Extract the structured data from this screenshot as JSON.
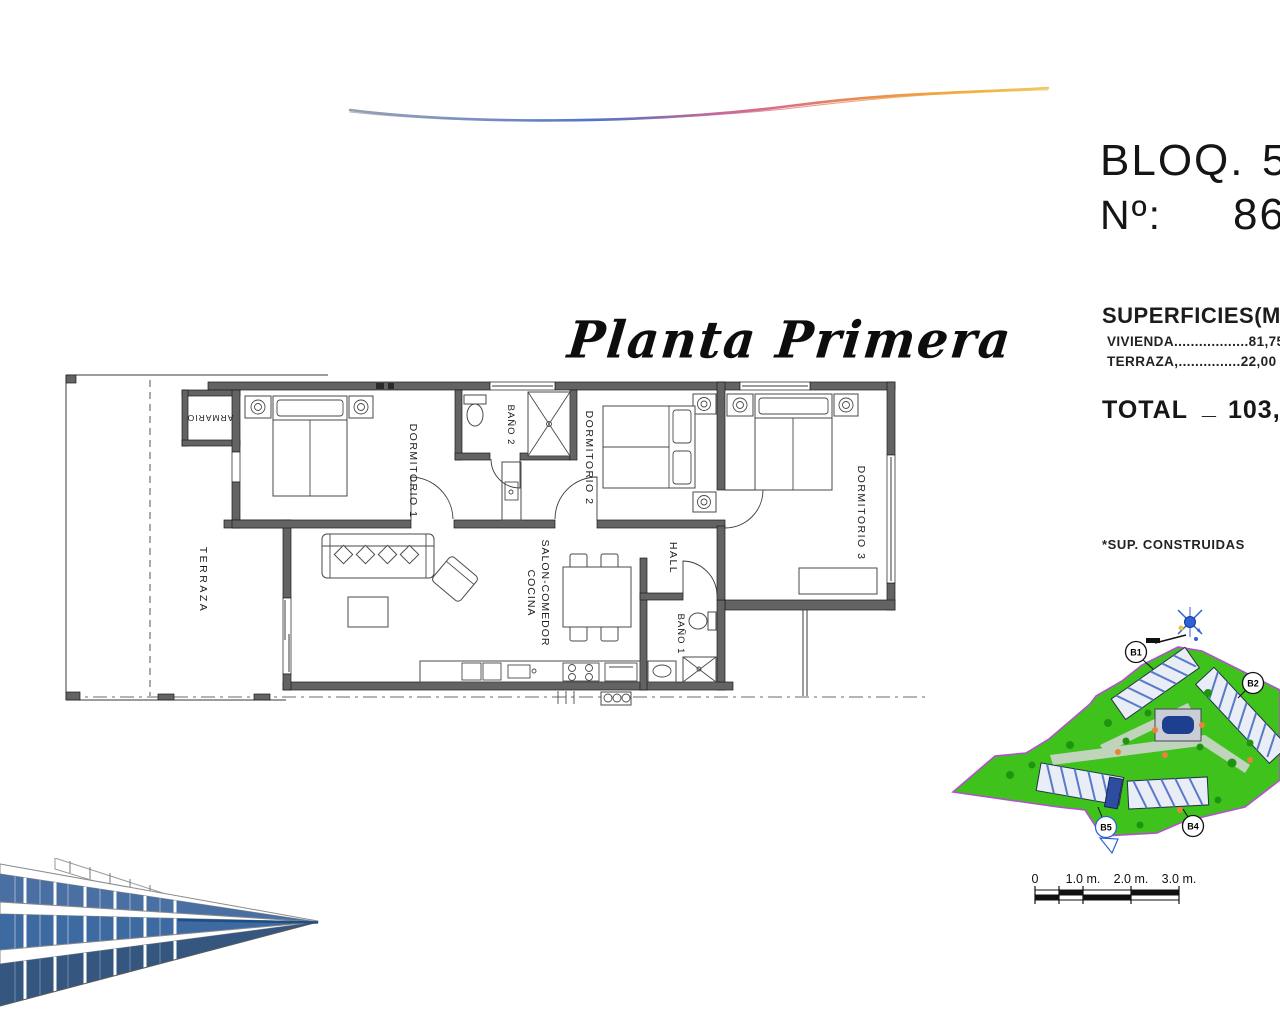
{
  "title_block": {
    "bloq_label": "BLOQ.",
    "bloq_value": "5",
    "num_label": "Nº:",
    "num_value": "86",
    "superficies_heading": "SUPERFICIES(M2",
    "vivienda_row": "VIVIENDA..................81,75*",
    "terraza_row": "TERRAZA,...............22,00",
    "total_label": "TOTAL",
    "total_separator": "_",
    "total_value": "103,75",
    "footnote": "*SUP. CONSTRUIDAS"
  },
  "floor_plan": {
    "title": "Planta Primera",
    "rooms": {
      "terraza": "TERRAZA",
      "armario": "ARMARIO",
      "dormitorio_1": "DORMITORIO 1",
      "bano_2": "BAÑO 2",
      "dormitorio_2": "DORMITORIO 2",
      "salon_line_1": "SALON-COMEDOR",
      "salon_line_2": "COCINA",
      "hall": "HALL",
      "bano_1": "BAÑO 1",
      "dormitorio_3": "DORMITORIO 3"
    }
  },
  "site_plan": {
    "block_labels": {
      "b1": "B1",
      "b2": "B2",
      "b4": "B4",
      "b5": "B5"
    }
  },
  "scale_bar": {
    "labels": [
      "0",
      "1.0 m.",
      "2.0 m.",
      "3.0 m."
    ]
  },
  "colors": {
    "site_green": "#3fc21c",
    "boundary_purple": "#b44fd0",
    "pool_blue": "#1d3f8f",
    "swoosh_blue": "#4f74c6",
    "swoosh_pink": "#df6f7f",
    "swoosh_orange": "#f3b13c",
    "render_blue": "#1d4e86",
    "wall_gray": "#636363"
  }
}
